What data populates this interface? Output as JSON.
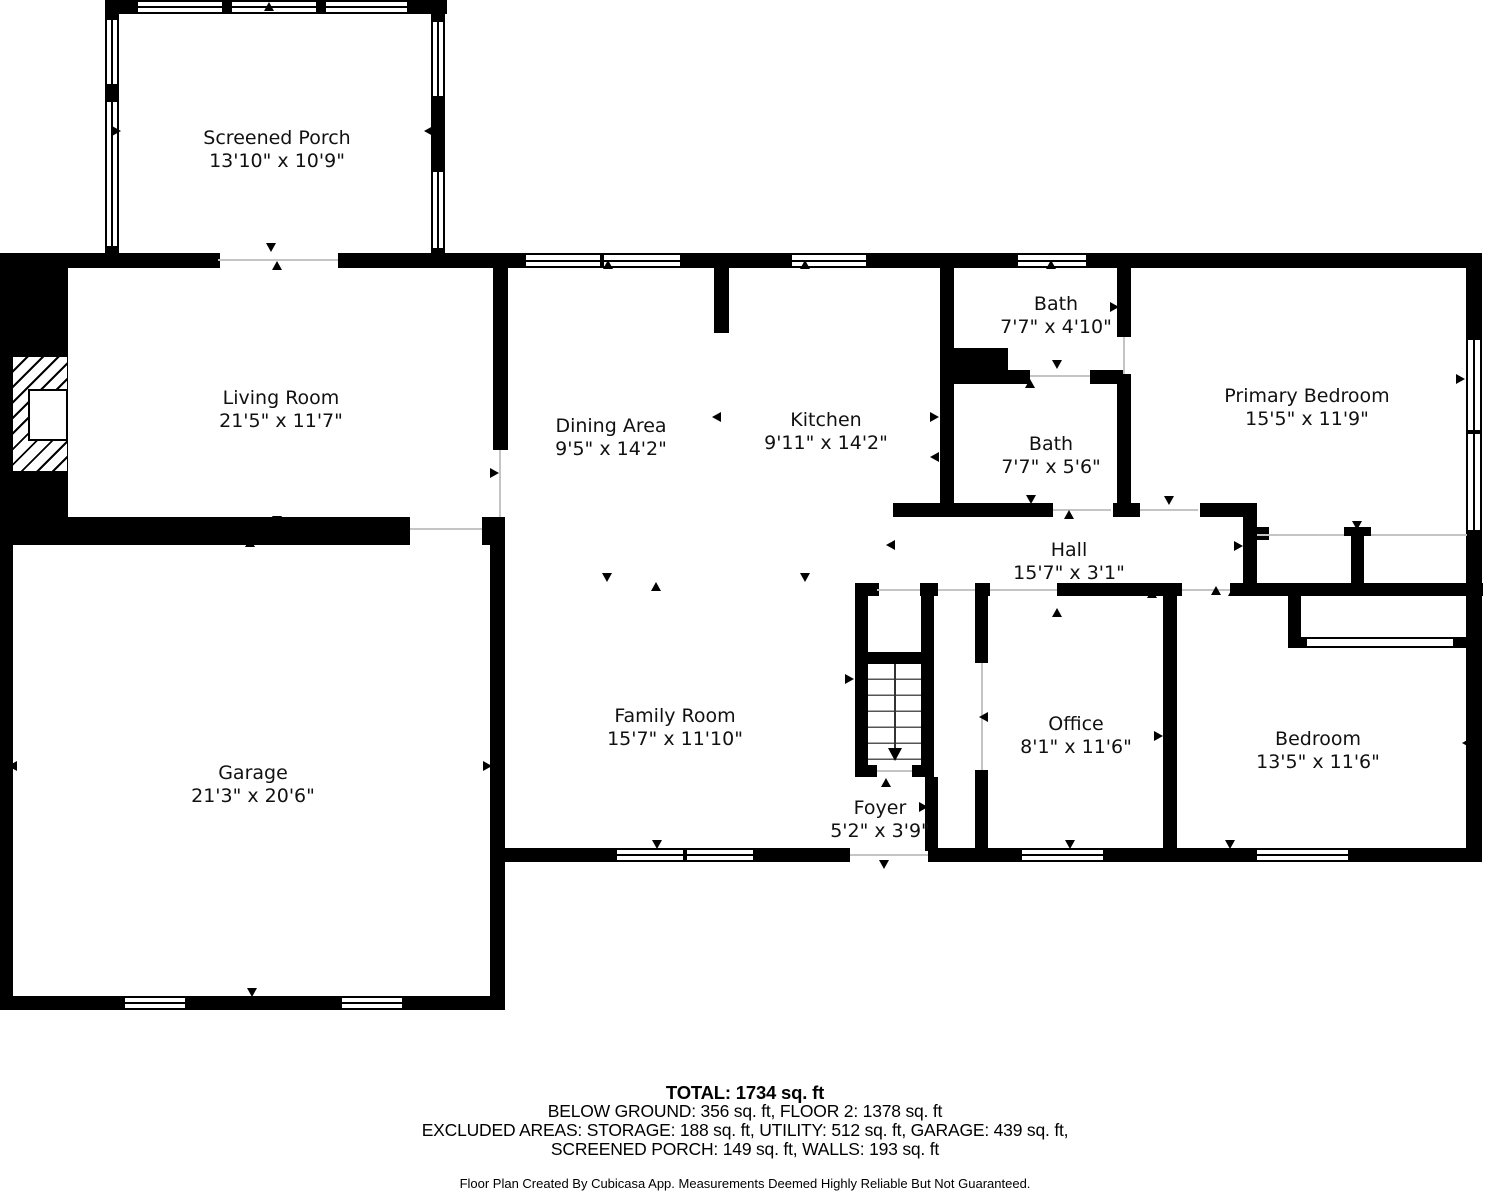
{
  "rooms": [
    {
      "name": "Screened Porch",
      "dims": "13'10\" x 10'9\""
    },
    {
      "name": "Living Room",
      "dims": "21'5\" x 11'7\""
    },
    {
      "name": "Dining Area",
      "dims": "9'5\" x 14'2\""
    },
    {
      "name": "Kitchen",
      "dims": "9'11\" x 14'2\""
    },
    {
      "name": "Bath",
      "dims": "7'7\" x 4'10\""
    },
    {
      "name": "Bath",
      "dims": "7'7\" x 5'6\""
    },
    {
      "name": "Primary Bedroom",
      "dims": "15'5\" x 11'9\""
    },
    {
      "name": "Hall",
      "dims": "15'7\" x 3'1\""
    },
    {
      "name": "Garage",
      "dims": "21'3\" x 20'6\""
    },
    {
      "name": "Family Room",
      "dims": "15'7\" x 11'10\""
    },
    {
      "name": "Office",
      "dims": "8'1\" x 11'6\""
    },
    {
      "name": "Bedroom",
      "dims": "13'5\" x 11'6\""
    },
    {
      "name": "Foyer",
      "dims": "5'2\" x 3'9\""
    }
  ],
  "footer": {
    "total": "TOTAL: 1734 sq. ft",
    "areas_line1": "BELOW GROUND: 356 sq. ft, FLOOR 2: 1378 sq. ft",
    "areas_line2": "EXCLUDED AREAS: STORAGE: 188 sq. ft, UTILITY: 512 sq. ft, GARAGE: 439 sq. ft,",
    "areas_line3": "SCREENED PORCH: 149 sq. ft, WALLS: 193 sq. ft",
    "credit": "Floor Plan Created By Cubicasa App. Measurements Deemed Highly Reliable But Not Guaranteed."
  },
  "colors": {
    "wall": "#000000",
    "floor": "#ffffff",
    "door_line": "#c4c4c4"
  }
}
